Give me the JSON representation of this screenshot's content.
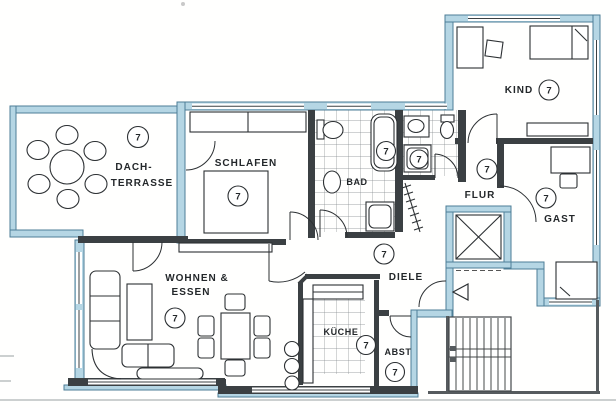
{
  "floorplan": {
    "description": "scanned apartment floor plan, unit 7, with roof terrace",
    "unit_number": "7",
    "labels": {
      "dach_line1": "DACH-",
      "dach_line2": "TERRASSE",
      "schlafen": "SCHLAFEN",
      "bad": "BAD",
      "kind": "KIND",
      "flur": "FLUR",
      "gast": "GAST",
      "wohnen_line1": "WOHNEN &",
      "wohnen_line2": "ESSEN",
      "diele": "DIELE",
      "kueche": "KÜCHE",
      "abst": "ABST"
    },
    "markers": [
      {
        "room": "dach-terrasse",
        "value": "7"
      },
      {
        "room": "schlafen",
        "value": "7"
      },
      {
        "room": "bad",
        "value": "7"
      },
      {
        "room": "wc-dusche",
        "value": "7"
      },
      {
        "room": "kind",
        "value": "7"
      },
      {
        "room": "flur",
        "value": "7"
      },
      {
        "room": "gast",
        "value": "7"
      },
      {
        "room": "wohnen-essen",
        "value": "7"
      },
      {
        "room": "diele",
        "value": "7"
      },
      {
        "room": "kueche",
        "value": "7"
      },
      {
        "room": "abst",
        "value": "7"
      }
    ],
    "colors": {
      "exterior_wall": "#b5d6e4",
      "exterior_outline": "#4d7e97",
      "interior_wall": "#3b4043",
      "drawing_line": "#2c3033",
      "paper": "#fffffe"
    }
  }
}
